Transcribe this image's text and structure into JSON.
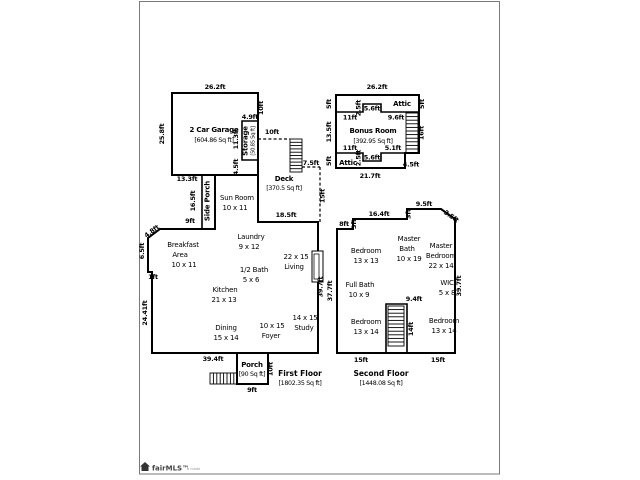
{
  "colors": {
    "wall": "#000000",
    "frame": "#7a7a7a",
    "background": "#ffffff"
  },
  "watermark": {
    "brand": "fairMLS™",
    "suffix": "b mode"
  },
  "first_floor": {
    "labels": [
      {
        "n": "dim-garage-top",
        "t": "26.2ft",
        "x": 215,
        "y": 89
      },
      {
        "n": "dim-garage-left",
        "t": "25.8ft",
        "x": 164,
        "y": 134,
        "rot": -90
      },
      {
        "n": "dim-garage-right-upper",
        "t": "10ft",
        "x": 263,
        "y": 108,
        "rot": -90
      },
      {
        "n": "dim-storage-top",
        "t": "4.9ft",
        "x": 250,
        "y": 119
      },
      {
        "n": "room-storage",
        "t": "Storage",
        "x": 247.5,
        "y": 141,
        "cls": "roomBold",
        "rot": -90
      },
      {
        "n": "area-storage",
        "t": "[50.85 Sq ft]",
        "x": 254.5,
        "y": 141,
        "cls": "tinyArea",
        "rot": -90
      },
      {
        "n": "dim-storage-left",
        "t": "11.3ft",
        "x": 238,
        "y": 139,
        "rot": -90
      },
      {
        "n": "dim-garage-right-lower",
        "t": "4.5ft",
        "x": 238,
        "y": 167,
        "rot": -90
      },
      {
        "n": "room-garage",
        "t": "2 Car Garage",
        "x": 214,
        "y": 132,
        "cls": "roomBold"
      },
      {
        "n": "area-garage",
        "t": "[604.86 Sq ft]",
        "x": 214,
        "y": 142,
        "cls": "area"
      },
      {
        "n": "dim-garage-bottom",
        "t": "13.3ft",
        "x": 187,
        "y": 181
      },
      {
        "n": "dim-side-porch",
        "t": "16.5ft",
        "x": 195,
        "y": 201,
        "rot": -90
      },
      {
        "n": "room-side-porch",
        "t": "Side Porch",
        "x": 209.5,
        "y": 201,
        "cls": "roomBold",
        "rot": -90
      },
      {
        "n": "room-sun-room",
        "t": "Sun Room",
        "x": 237,
        "y": 200,
        "cls": "room"
      },
      {
        "n": "dims-sun-room",
        "t": "10 x 11",
        "x": 235,
        "y": 210,
        "cls": "room"
      },
      {
        "n": "dim-deck-top",
        "t": "10ft",
        "x": 272,
        "y": 134
      },
      {
        "n": "dim-deck-stairs",
        "t": "7.5ft",
        "x": 311,
        "y": 165
      },
      {
        "n": "room-deck",
        "t": "Deck",
        "x": 284,
        "y": 181,
        "cls": "roomBold"
      },
      {
        "n": "area-deck",
        "t": "[370.5 Sq ft]",
        "x": 284,
        "y": 190,
        "cls": "area"
      },
      {
        "n": "dim-deck-right",
        "t": "15ft",
        "x": 324.5,
        "y": 196,
        "rot": -90
      },
      {
        "n": "dim-living-top",
        "t": "18.5ft",
        "x": 286,
        "y": 217
      },
      {
        "n": "dim-breakfast-top",
        "t": "9ft",
        "x": 190,
        "y": 223
      },
      {
        "n": "dim-breakfast-angle",
        "t": "4.8ft",
        "x": 153,
        "y": 233,
        "rot": -37
      },
      {
        "n": "dim-breakfast-left",
        "t": "6.5ft",
        "x": 144,
        "y": 251,
        "rot": -90
      },
      {
        "n": "dim-left-jog",
        "t": "1ft",
        "x": 153,
        "y": 279
      },
      {
        "n": "dim-left-wall",
        "t": "24.41ft",
        "x": 147,
        "y": 313,
        "rot": -90
      },
      {
        "n": "room-breakfast-1",
        "t": "Breakfast",
        "x": 183,
        "y": 247,
        "cls": "room"
      },
      {
        "n": "room-breakfast-2",
        "t": "Area",
        "x": 180,
        "y": 257,
        "cls": "room"
      },
      {
        "n": "dims-breakfast",
        "t": "10 x 11",
        "x": 184,
        "y": 267,
        "cls": "room"
      },
      {
        "n": "room-laundry",
        "t": "Laundry",
        "x": 251,
        "y": 239,
        "cls": "room"
      },
      {
        "n": "dims-laundry",
        "t": "9 x 12",
        "x": 249,
        "y": 249,
        "cls": "room"
      },
      {
        "n": "dims-living",
        "t": "22 x 15",
        "x": 296,
        "y": 259,
        "cls": "room"
      },
      {
        "n": "room-living",
        "t": "Living",
        "x": 294,
        "y": 269,
        "cls": "room"
      },
      {
        "n": "room-half-bath",
        "t": "1/2 Bath",
        "x": 254,
        "y": 272,
        "cls": "room"
      },
      {
        "n": "dims-half-bath",
        "t": "5 x 6",
        "x": 251,
        "y": 282,
        "cls": "room"
      },
      {
        "n": "room-kitchen",
        "t": "Kitchen",
        "x": 225,
        "y": 292,
        "cls": "room"
      },
      {
        "n": "dims-kitchen",
        "t": "21 x 13",
        "x": 224,
        "y": 302,
        "cls": "room"
      },
      {
        "n": "room-dining",
        "t": "Dining",
        "x": 226,
        "y": 330,
        "cls": "room"
      },
      {
        "n": "dims-dining",
        "t": "15 x 14",
        "x": 226,
        "y": 340,
        "cls": "room"
      },
      {
        "n": "dims-foyer",
        "t": "10 x 15",
        "x": 272,
        "y": 328,
        "cls": "room"
      },
      {
        "n": "room-foyer",
        "t": "Foyer",
        "x": 271,
        "y": 338,
        "cls": "room"
      },
      {
        "n": "dims-study",
        "t": "14 x 15",
        "x": 305,
        "y": 320,
        "cls": "room"
      },
      {
        "n": "room-study",
        "t": "Study",
        "x": 304,
        "y": 330,
        "cls": "room"
      },
      {
        "n": "dim-right-wall",
        "t": "39.7ft",
        "x": 322.5,
        "y": 287,
        "rot": -90
      },
      {
        "n": "dim-bottom-wall",
        "t": "39.4ft",
        "x": 213,
        "y": 361
      },
      {
        "n": "room-porch",
        "t": "Porch",
        "x": 252,
        "y": 367,
        "cls": "roomBold"
      },
      {
        "n": "area-porch",
        "t": "[90 Sq ft]",
        "x": 252,
        "y": 376,
        "cls": "area"
      },
      {
        "n": "dim-porch-right",
        "t": "10ft",
        "x": 272.5,
        "y": 369,
        "rot": -90
      },
      {
        "n": "dim-porch-bottom",
        "t": "9ft",
        "x": 252,
        "y": 392
      },
      {
        "n": "title-first-floor",
        "t": "First Floor",
        "x": 300,
        "y": 376,
        "cls": "title"
      },
      {
        "n": "area-first-floor",
        "t": "[1802.35 Sq ft]",
        "x": 300,
        "y": 385,
        "cls": "area"
      }
    ]
  },
  "bonus_room": {
    "labels": [
      {
        "n": "dim-bonus-top",
        "t": "26.2ft",
        "x": 377,
        "y": 89
      },
      {
        "n": "dim-bonus-left-top",
        "t": "5ft",
        "x": 331,
        "y": 104,
        "rot": -90
      },
      {
        "n": "dim-bonus-left-mid",
        "t": "13.5ft",
        "x": 331,
        "y": 132,
        "rot": -90
      },
      {
        "n": "dim-bonus-left-bottom",
        "t": "5ft",
        "x": 331,
        "y": 161,
        "rot": -90
      },
      {
        "n": "dim-attic-notch-top-h",
        "t": "2.5ft",
        "x": 360.5,
        "y": 108,
        "rot": -90
      },
      {
        "n": "dim-attic-notch-top-w",
        "t": "5.6ft",
        "x": 372,
        "y": 110.5
      },
      {
        "n": "room-attic-top",
        "t": "Attic",
        "x": 402,
        "y": 106,
        "cls": "roomBold"
      },
      {
        "n": "dim-bonus-right-top",
        "t": "5ft",
        "x": 424,
        "y": 104,
        "rot": -90
      },
      {
        "n": "dim-attic-top-left",
        "t": "11ft",
        "x": 350,
        "y": 119.5
      },
      {
        "n": "dim-attic-top-right",
        "t": "9.6ft",
        "x": 396,
        "y": 119.5
      },
      {
        "n": "room-bonus",
        "t": "Bonus Room",
        "x": 373,
        "y": 133,
        "cls": "roomBold"
      },
      {
        "n": "area-bonus",
        "t": "[392.95 Sq ft]",
        "x": 373,
        "y": 143,
        "cls": "area"
      },
      {
        "n": "dim-bonus-stairs",
        "t": "16ft",
        "x": 423.5,
        "y": 133,
        "rot": -90
      },
      {
        "n": "dim-attic-bottom-left",
        "t": "11ft",
        "x": 350,
        "y": 150
      },
      {
        "n": "dim-attic-bottom-right",
        "t": "5.1ft",
        "x": 393,
        "y": 150
      },
      {
        "n": "dim-attic-notch-bottom-h",
        "t": "2.5ft",
        "x": 360.5,
        "y": 158,
        "rot": -90
      },
      {
        "n": "dim-attic-notch-bottom-w",
        "t": "5.6ft",
        "x": 372,
        "y": 159.5
      },
      {
        "n": "room-attic-bottom",
        "t": "Attic",
        "x": 348,
        "y": 165,
        "cls": "roomBold"
      },
      {
        "n": "dim-bonus-step",
        "t": "4.5ft",
        "x": 411,
        "y": 166.5
      },
      {
        "n": "dim-bonus-bottom",
        "t": "21.7ft",
        "x": 370,
        "y": 178
      }
    ]
  },
  "second_floor": {
    "labels": [
      {
        "n": "dim-2f-top-1",
        "t": "8ft",
        "x": 344,
        "y": 226
      },
      {
        "n": "dim-2f-step-1",
        "t": "3ft",
        "x": 356,
        "y": 224,
        "rot": -90
      },
      {
        "n": "dim-2f-top-2",
        "t": "16.4ft",
        "x": 379,
        "y": 216
      },
      {
        "n": "dim-2f-step-2",
        "t": "3ft",
        "x": 410.5,
        "y": 214,
        "rot": -90
      },
      {
        "n": "dim-2f-top-3",
        "t": "9.5ft",
        "x": 424,
        "y": 206
      },
      {
        "n": "dim-2f-angle",
        "t": "3.5ft",
        "x": 450,
        "y": 218,
        "rot": 35
      },
      {
        "n": "dim-2f-left",
        "t": "37.7ft",
        "x": 332,
        "y": 291,
        "rot": -90
      },
      {
        "n": "dim-2f-right",
        "t": "39.7ft",
        "x": 461,
        "y": 286,
        "rot": -90
      },
      {
        "n": "room-bedroom-tl",
        "t": "Bedroom",
        "x": 366,
        "y": 253,
        "cls": "room"
      },
      {
        "n": "dims-bedroom-tl",
        "t": "13 x 13",
        "x": 366,
        "y": 263,
        "cls": "room"
      },
      {
        "n": "room-master-bath-1",
        "t": "Master",
        "x": 409,
        "y": 241,
        "cls": "room"
      },
      {
        "n": "room-master-bath-2",
        "t": "Bath",
        "x": 407,
        "y": 251,
        "cls": "room"
      },
      {
        "n": "dims-master-bath",
        "t": "10 x 19",
        "x": 409,
        "y": 261,
        "cls": "room"
      },
      {
        "n": "room-master-bed-1",
        "t": "Master",
        "x": 441,
        "y": 248,
        "cls": "room"
      },
      {
        "n": "room-master-bed-2",
        "t": "Bedroom",
        "x": 441,
        "y": 258,
        "cls": "room"
      },
      {
        "n": "dims-master-bed",
        "t": "22 x 14",
        "x": 441,
        "y": 268,
        "cls": "room"
      },
      {
        "n": "room-full-bath",
        "t": "Full Bath",
        "x": 360,
        "y": 287,
        "cls": "room"
      },
      {
        "n": "dims-full-bath",
        "t": "10 x 9",
        "x": 359,
        "y": 297,
        "cls": "room"
      },
      {
        "n": "room-wic",
        "t": "WIC",
        "x": 447,
        "y": 285,
        "cls": "room"
      },
      {
        "n": "dims-wic",
        "t": "5 x 8",
        "x": 447,
        "y": 295,
        "cls": "room"
      },
      {
        "n": "dim-stairwell-top",
        "t": "9.4ft",
        "x": 414,
        "y": 301
      },
      {
        "n": "dim-stairwell-right",
        "t": "14ft",
        "x": 413,
        "y": 329,
        "rot": -90
      },
      {
        "n": "room-bedroom-bl",
        "t": "Bedroom",
        "x": 366,
        "y": 324,
        "cls": "room"
      },
      {
        "n": "dims-bedroom-bl",
        "t": "13 x 14",
        "x": 366,
        "y": 334,
        "cls": "room"
      },
      {
        "n": "room-bedroom-br",
        "t": "Bedroom",
        "x": 444,
        "y": 323,
        "cls": "room"
      },
      {
        "n": "dims-bedroom-br",
        "t": "13 x 14",
        "x": 444,
        "y": 333,
        "cls": "room"
      },
      {
        "n": "dim-2f-bottom-left",
        "t": "15ft",
        "x": 361,
        "y": 362
      },
      {
        "n": "dim-2f-bottom-right",
        "t": "15ft",
        "x": 438,
        "y": 362
      },
      {
        "n": "title-second-floor",
        "t": "Second Floor",
        "x": 381,
        "y": 376,
        "cls": "title"
      },
      {
        "n": "area-second-floor",
        "t": "[1448.08 Sq ft]",
        "x": 381,
        "y": 385,
        "cls": "area"
      }
    ]
  }
}
